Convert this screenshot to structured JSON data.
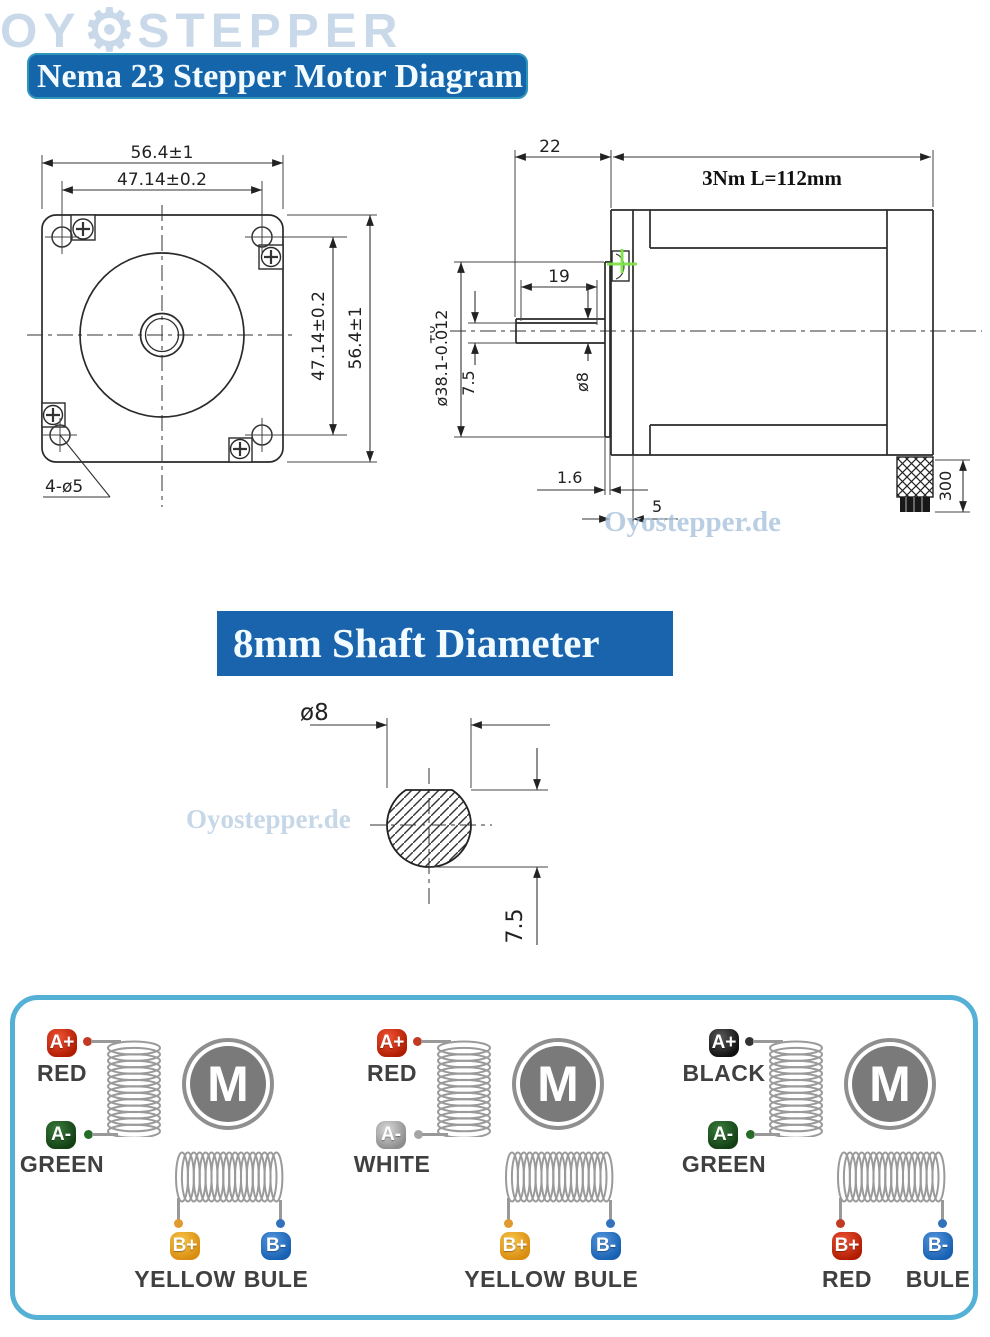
{
  "title_banner": {
    "text": "Nema 23 Stepper Motor Diagram"
  },
  "shaft_banner": {
    "text": "8mm Shaft Diameter"
  },
  "watermarks": {
    "site": "Oyostepper.de",
    "brand_left": "OY",
    "brand_right": "STEPPER",
    "gear_glyph": "⚙"
  },
  "front_view": {
    "dim_width_top": "56.4±1",
    "dim_holes_h": "47.14±0.2",
    "dim_holes_v": "47.14±0.2",
    "dim_height_right": "56.4±1",
    "holes_note": "4-ø5"
  },
  "side_view": {
    "dim_front": "22",
    "body_label": "3Nm L=112mm",
    "dim_flat_len": "19",
    "dim_pilot_tol": "+0",
    "dim_pilot": "ø38.1-0.012",
    "dim_flat_h": "7.5",
    "dim_shaft_d": "ø8",
    "dim_plate": "1.6",
    "dim_boss": "5",
    "dim_cable": "300"
  },
  "cross_section": {
    "dim_dia": "ø8",
    "dim_flat": "7.5"
  },
  "wiring": {
    "motor_label": "M",
    "units": [
      {
        "terminals": [
          {
            "tag": "A+",
            "label": "RED",
            "hi": "#ef5335",
            "lo": "#b01c02",
            "dot": "#c23a24"
          },
          {
            "tag": "A-",
            "label": "GREEN",
            "hi": "#3a7d3c",
            "lo": "#123f14",
            "dot": "#266b28"
          },
          {
            "tag": "B+",
            "label": "YELLOW",
            "hi": "#f8c54a",
            "lo": "#d88c10",
            "dot": "#e09a30"
          },
          {
            "tag": "B-",
            "label": "BULE",
            "hi": "#5596dd",
            "lo": "#1760b2",
            "dot": "#3272bd"
          }
        ]
      },
      {
        "terminals": [
          {
            "tag": "A+",
            "label": "RED",
            "hi": "#ef5335",
            "lo": "#b01c02",
            "dot": "#c23a24"
          },
          {
            "tag": "A-",
            "label": "WHITE",
            "hi": "#d8d8d8",
            "lo": "#8d8d8d",
            "dot": "#a5a5a5"
          },
          {
            "tag": "B+",
            "label": "YELLOW",
            "hi": "#f8c54a",
            "lo": "#d88c10",
            "dot": "#e09a30"
          },
          {
            "tag": "B-",
            "label": "BULE",
            "hi": "#5596dd",
            "lo": "#1760b2",
            "dot": "#3272bd"
          }
        ]
      },
      {
        "terminals": [
          {
            "tag": "A+",
            "label": "BLACK",
            "hi": "#5a5a5a",
            "lo": "#101010",
            "dot": "#333333"
          },
          {
            "tag": "A-",
            "label": "GREEN",
            "hi": "#3a7d3c",
            "lo": "#123f14",
            "dot": "#266b28"
          },
          {
            "tag": "B+",
            "label": "RED",
            "hi": "#ef5335",
            "lo": "#b01c02",
            "dot": "#c23a24"
          },
          {
            "tag": "B-",
            "label": "BULE",
            "hi": "#5596dd",
            "lo": "#1760b2",
            "dot": "#3272bd"
          }
        ]
      }
    ]
  },
  "colors": {
    "banner_bg": "#1565ab",
    "banner2_bg": "#1a63ad",
    "panel_border": "#54b0d4",
    "marker_green": "#7ce24a",
    "watermark": "#a9c3dd"
  }
}
